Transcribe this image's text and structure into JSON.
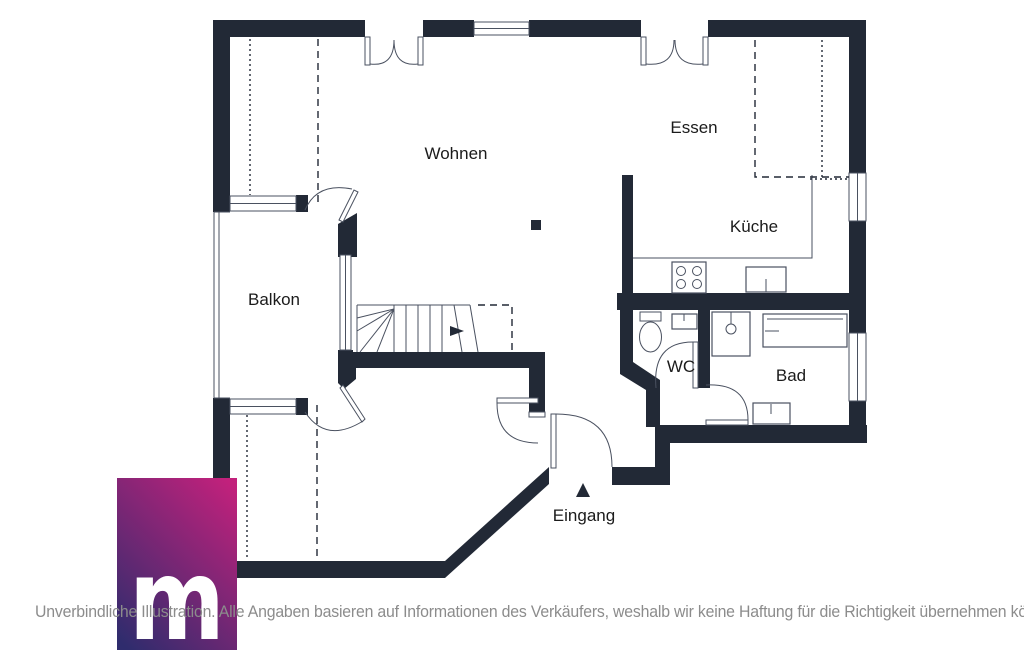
{
  "colors": {
    "wall": "#222936",
    "line": "#4a5160",
    "label_text": "#1b1b1b",
    "disclaimer_text": "#8c8c8c"
  },
  "floor_plan": {
    "rooms": [
      {
        "id": "wohnen",
        "label": "Wohnen"
      },
      {
        "id": "essen",
        "label": "Essen"
      },
      {
        "id": "kueche",
        "label": "Küche"
      },
      {
        "id": "balkon",
        "label": "Balkon"
      },
      {
        "id": "wc",
        "label": "WC"
      },
      {
        "id": "bad",
        "label": "Bad"
      }
    ],
    "entrance": {
      "label": "Eingang",
      "arrow_icon": "arrow-up-triangle"
    },
    "fixture_icons": [
      "stairs-icon",
      "stove-icon",
      "kitchen-sink-icon",
      "toilet-icon",
      "washbasin-icon",
      "shower-icon",
      "bathtub-icon",
      "column-marker"
    ]
  },
  "branding": {
    "logo_letter": "m",
    "logo_gradient_top_right": "#c2217c",
    "logo_gradient_bottom_left": "#2f2c6d"
  },
  "footer": {
    "disclaimer": "Unverbindliche Illustration. Alle Angaben basieren auf Informationen des Verkäufers, weshalb wir keine Haftung für die Richtigkeit übernehmen können."
  }
}
